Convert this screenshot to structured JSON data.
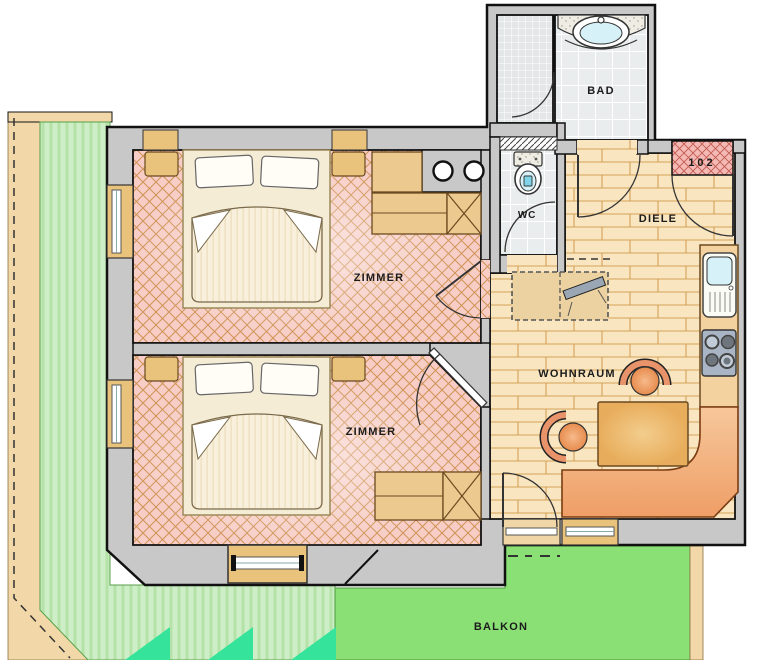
{
  "plan": {
    "unit_number": "102",
    "labels": {
      "bad": "BAD",
      "wc": "WC",
      "diele": "DIELE",
      "wohnraum": "WOHNRAUM",
      "zimmer_top": "ZIMMER",
      "zimmer_bottom": "ZIMMER",
      "balkon": "BALKON"
    },
    "colors": {
      "wall": "#c8c8c8",
      "outline": "#141414",
      "carpet": "#f7cdc6",
      "carpet_hatch": "#cf9355",
      "wood": "#f9e6c0",
      "wood_line": "#d3a159",
      "tile": "#eaeded",
      "shower_tile": "#e3e7e7",
      "balcony_light": "#cdeec6",
      "balcony_dark": "#8adf75",
      "balcony_plant": "#35e39b",
      "terrace_edge": "#f2d8a8",
      "bench": "#ef9e66",
      "table": "#e8ad5c",
      "cabinet": "#ecc98f",
      "counter": "#f3d2a0",
      "basin_blue": "#d6f1f8",
      "stove": "#a9b5c5",
      "door_mat": "#f4b9b4"
    }
  }
}
